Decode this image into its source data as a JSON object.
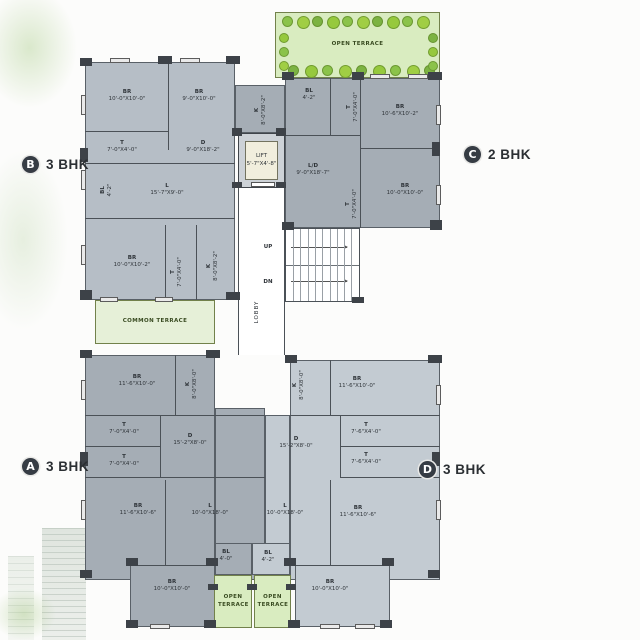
{
  "unit_badges": [
    {
      "letter": "B",
      "type": "3 BHK",
      "x": 22,
      "y": 156
    },
    {
      "letter": "C",
      "type": "2 BHK",
      "x": 464,
      "y": 146
    },
    {
      "letter": "A",
      "type": "3 BHK",
      "x": 22,
      "y": 458
    },
    {
      "letter": "D",
      "type": "3 BHK",
      "x": 419,
      "y": 461
    }
  ],
  "terraces": [
    {
      "label": "OPEN TERRACE",
      "x": 275,
      "y": 12,
      "w": 165,
      "h": 66,
      "trees": true,
      "shade": "bright",
      "wrap": false
    },
    {
      "label": "COMMON TERRACE",
      "x": 95,
      "y": 300,
      "w": 120,
      "h": 44,
      "trees": false,
      "shade": "pale",
      "wrap": false
    },
    {
      "label": "OPEN TERRACE",
      "x": 214,
      "y": 575,
      "w": 38,
      "h": 53,
      "trees": false,
      "shade": "bright",
      "wrap": true
    },
    {
      "label": "OPEN TERRACE",
      "x": 254,
      "y": 575,
      "w": 37,
      "h": 53,
      "trees": false,
      "shade": "bright",
      "wrap": true
    }
  ],
  "core": {
    "lift_label": "LIFT",
    "lift_dim": "5'-7\"X4'-8\"",
    "lobby_label": "LOBBY",
    "up_label": "UP",
    "dn_label": "DN"
  },
  "rooms": [
    {
      "unit": "B",
      "name": "BR",
      "dim": "10'-0\"X10'-0\"",
      "x": 127,
      "y": 96,
      "vert": false
    },
    {
      "unit": "B",
      "name": "BR",
      "dim": "9'-0\"X10'-0\"",
      "x": 199,
      "y": 96,
      "vert": false
    },
    {
      "unit": "B",
      "name": "T",
      "dim": "7'-0\"X4'-0\"",
      "x": 122,
      "y": 147,
      "vert": false
    },
    {
      "unit": "B",
      "name": "D",
      "dim": "9'-0\"X18'-2\"",
      "x": 203,
      "y": 147,
      "vert": false
    },
    {
      "unit": "B",
      "name": "BL",
      "dim": "4'-2\"",
      "x": 107,
      "y": 190,
      "vert": true
    },
    {
      "unit": "B",
      "name": "L",
      "dim": "15'-7\"X9'-0\"",
      "x": 167,
      "y": 190,
      "vert": false
    },
    {
      "unit": "B",
      "name": "BR",
      "dim": "10'-0\"X10'-2\"",
      "x": 132,
      "y": 262,
      "vert": false
    },
    {
      "unit": "B",
      "name": "T",
      "dim": "7'-0\"X4'-0\"",
      "x": 177,
      "y": 272,
      "vert": true
    },
    {
      "unit": "B",
      "name": "K",
      "dim": "8'-0\"X8'-2\"",
      "x": 213,
      "y": 266,
      "vert": true
    },
    {
      "unit": "C",
      "name": "K",
      "dim": "8'-0\"X8'-2\"",
      "x": 261,
      "y": 110,
      "vert": true
    },
    {
      "unit": "C",
      "name": "BL",
      "dim": "4'-2\"",
      "x": 309,
      "y": 95,
      "vert": false
    },
    {
      "unit": "C",
      "name": "T",
      "dim": "7'-0\"X4'-0\"",
      "x": 353,
      "y": 107,
      "vert": true
    },
    {
      "unit": "C",
      "name": "BR",
      "dim": "10'-6\"X10'-2\"",
      "x": 400,
      "y": 111,
      "vert": false
    },
    {
      "unit": "C",
      "name": "L/D",
      "dim": "9'-0\"X18'-7\"",
      "x": 313,
      "y": 170,
      "vert": false
    },
    {
      "unit": "C",
      "name": "T",
      "dim": "7'-0\"X4'-0\"",
      "x": 352,
      "y": 204,
      "vert": true
    },
    {
      "unit": "C",
      "name": "BR",
      "dim": "10'-0\"X10'-0\"",
      "x": 405,
      "y": 190,
      "vert": false
    },
    {
      "unit": "A",
      "name": "BR",
      "dim": "11'-6\"X10'-0\"",
      "x": 137,
      "y": 381,
      "vert": false
    },
    {
      "unit": "A",
      "name": "K",
      "dim": "8'-0\"X8'-0\"",
      "x": 192,
      "y": 384,
      "vert": true
    },
    {
      "unit": "A",
      "name": "T",
      "dim": "7'-0\"X4'-0\"",
      "x": 124,
      "y": 429,
      "vert": false
    },
    {
      "unit": "A",
      "name": "T",
      "dim": "7'-0\"X4'-0\"",
      "x": 124,
      "y": 461,
      "vert": false
    },
    {
      "unit": "A",
      "name": "D",
      "dim": "15'-2\"X8'-0\"",
      "x": 190,
      "y": 440,
      "vert": false
    },
    {
      "unit": "A",
      "name": "BR",
      "dim": "11'-6\"X10'-6\"",
      "x": 138,
      "y": 510,
      "vert": false
    },
    {
      "unit": "A",
      "name": "L",
      "dim": "10'-0\"X18'-0\"",
      "x": 210,
      "y": 510,
      "vert": false
    },
    {
      "unit": "A",
      "name": "BL",
      "dim": "4'-0\"",
      "x": 226,
      "y": 556,
      "vert": false
    },
    {
      "unit": "A",
      "name": "BR",
      "dim": "10'-0\"X10'-0\"",
      "x": 172,
      "y": 586,
      "vert": false
    },
    {
      "unit": "D",
      "name": "K",
      "dim": "8'-0\"X8'-0\"",
      "x": 299,
      "y": 385,
      "vert": true
    },
    {
      "unit": "D",
      "name": "BR",
      "dim": "11'-6\"X10'-0\"",
      "x": 357,
      "y": 383,
      "vert": false
    },
    {
      "unit": "D",
      "name": "T",
      "dim": "7'-6\"X4'-0\"",
      "x": 366,
      "y": 429,
      "vert": false
    },
    {
      "unit": "D",
      "name": "T",
      "dim": "7'-6\"X4'-0\"",
      "x": 366,
      "y": 459,
      "vert": false
    },
    {
      "unit": "D",
      "name": "D",
      "dim": "15'-2\"X8'-0\"",
      "x": 296,
      "y": 443,
      "vert": false
    },
    {
      "unit": "D",
      "name": "L",
      "dim": "10'-0\"X18'-0\"",
      "x": 285,
      "y": 510,
      "vert": false
    },
    {
      "unit": "D",
      "name": "BR",
      "dim": "11'-6\"X10'-6\"",
      "x": 358,
      "y": 512,
      "vert": false
    },
    {
      "unit": "D",
      "name": "BL",
      "dim": "4'-2\"",
      "x": 268,
      "y": 557,
      "vert": false
    },
    {
      "unit": "D",
      "name": "BR",
      "dim": "10'-0\"X10'-0\"",
      "x": 330,
      "y": 586,
      "vert": false
    }
  ],
  "colors": {
    "unit_b_fill": "#b6bec6",
    "unit_c_fill": "#a5adb5",
    "unit_a_fill": "#a5adb5",
    "unit_d_fill": "#c3cbd2",
    "terrace_green": "#d9ecc0",
    "terrace_pale": "#e6f0d8",
    "wall": "#4b5157",
    "lift_fill": "#f1eedd",
    "tree_greens": [
      "#8bc34a",
      "#a0ce44",
      "#7cb342",
      "#96c93d"
    ]
  }
}
